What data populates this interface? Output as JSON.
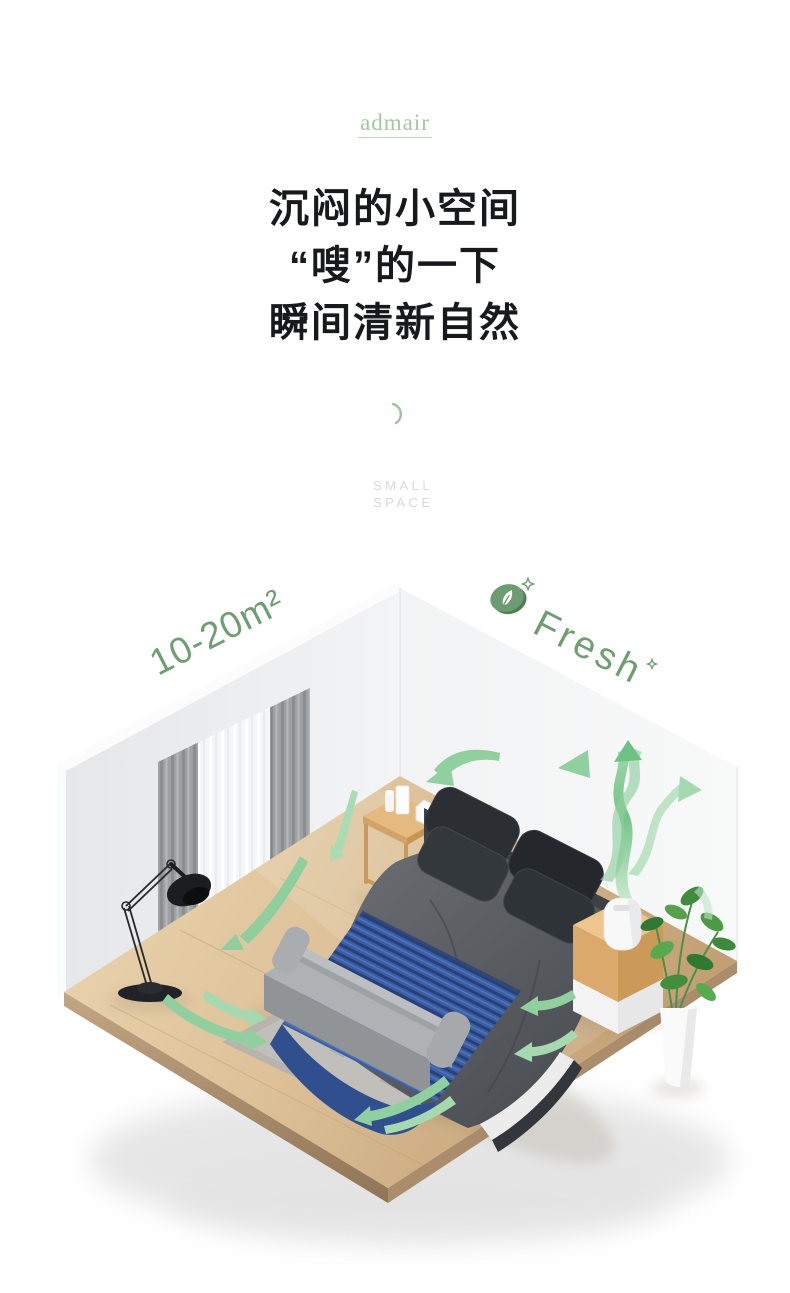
{
  "brand": {
    "logo_text": "admair"
  },
  "headline": {
    "line1": "沉闷的小空间",
    "line2": "“嗖”的一下",
    "line3": "瞬间清新自然"
  },
  "eyebrow": {
    "word1": "SMALL",
    "word2": "SPACE"
  },
  "room": {
    "area_label": "10-20m²",
    "fresh_label": "Fresh"
  },
  "colors": {
    "logo_green": "#a6c5a1",
    "accent_green": "#6d9f70",
    "arrow_green": "#8fd09e",
    "headline_dark": "#17191d",
    "eyebrow_gray": "#d8d9da",
    "wood_floor": "#dcc096",
    "blanket_blue": "#3a5ea6"
  }
}
